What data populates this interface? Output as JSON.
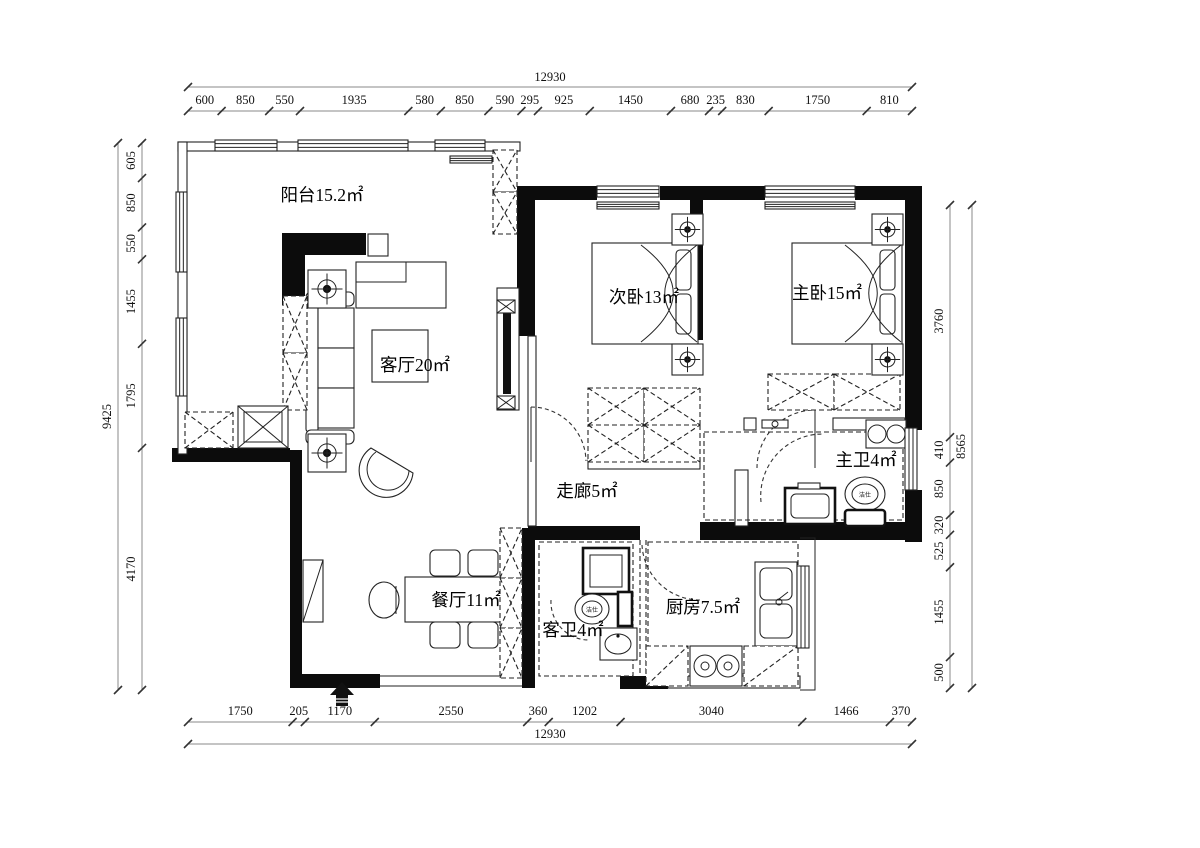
{
  "plan": {
    "type": "apartment-floor-plan",
    "rooms": {
      "balcony": {
        "label": "阳台15.2㎡"
      },
      "living": {
        "label": "客厅20㎡"
      },
      "bedroom2": {
        "label": "次卧13㎡"
      },
      "master_bedroom": {
        "label": "主卧15㎡"
      },
      "corridor": {
        "label": "走廊5㎡"
      },
      "master_bath": {
        "label": "主卫4㎡"
      },
      "dining": {
        "label": "餐厅11㎡"
      },
      "guest_bath": {
        "label": "客卫4㎡"
      },
      "kitchen": {
        "label": "厨房7.5㎡"
      }
    },
    "fixtures": {
      "toilet_brand": "洁仕"
    },
    "colors": {
      "wall": "#0c0c0c",
      "line": "#222222",
      "background": "#ffffff"
    }
  },
  "dimensions": {
    "top": {
      "total": "12930",
      "segments": [
        600,
        850,
        550,
        1935,
        580,
        850,
        590,
        295,
        925,
        1450,
        680,
        235,
        830,
        1750,
        810
      ]
    },
    "bottom": {
      "total": "12930",
      "segments": [
        1750,
        205,
        1170,
        2550,
        360,
        1202,
        3040,
        1466,
        370
      ]
    },
    "left": {
      "total": "9425",
      "segments": [
        605,
        850,
        550,
        1455,
        1795,
        4170
      ]
    },
    "right": {
      "total": "8565",
      "segments": [
        3760,
        410,
        850,
        320,
        525,
        1455,
        500
      ]
    }
  }
}
